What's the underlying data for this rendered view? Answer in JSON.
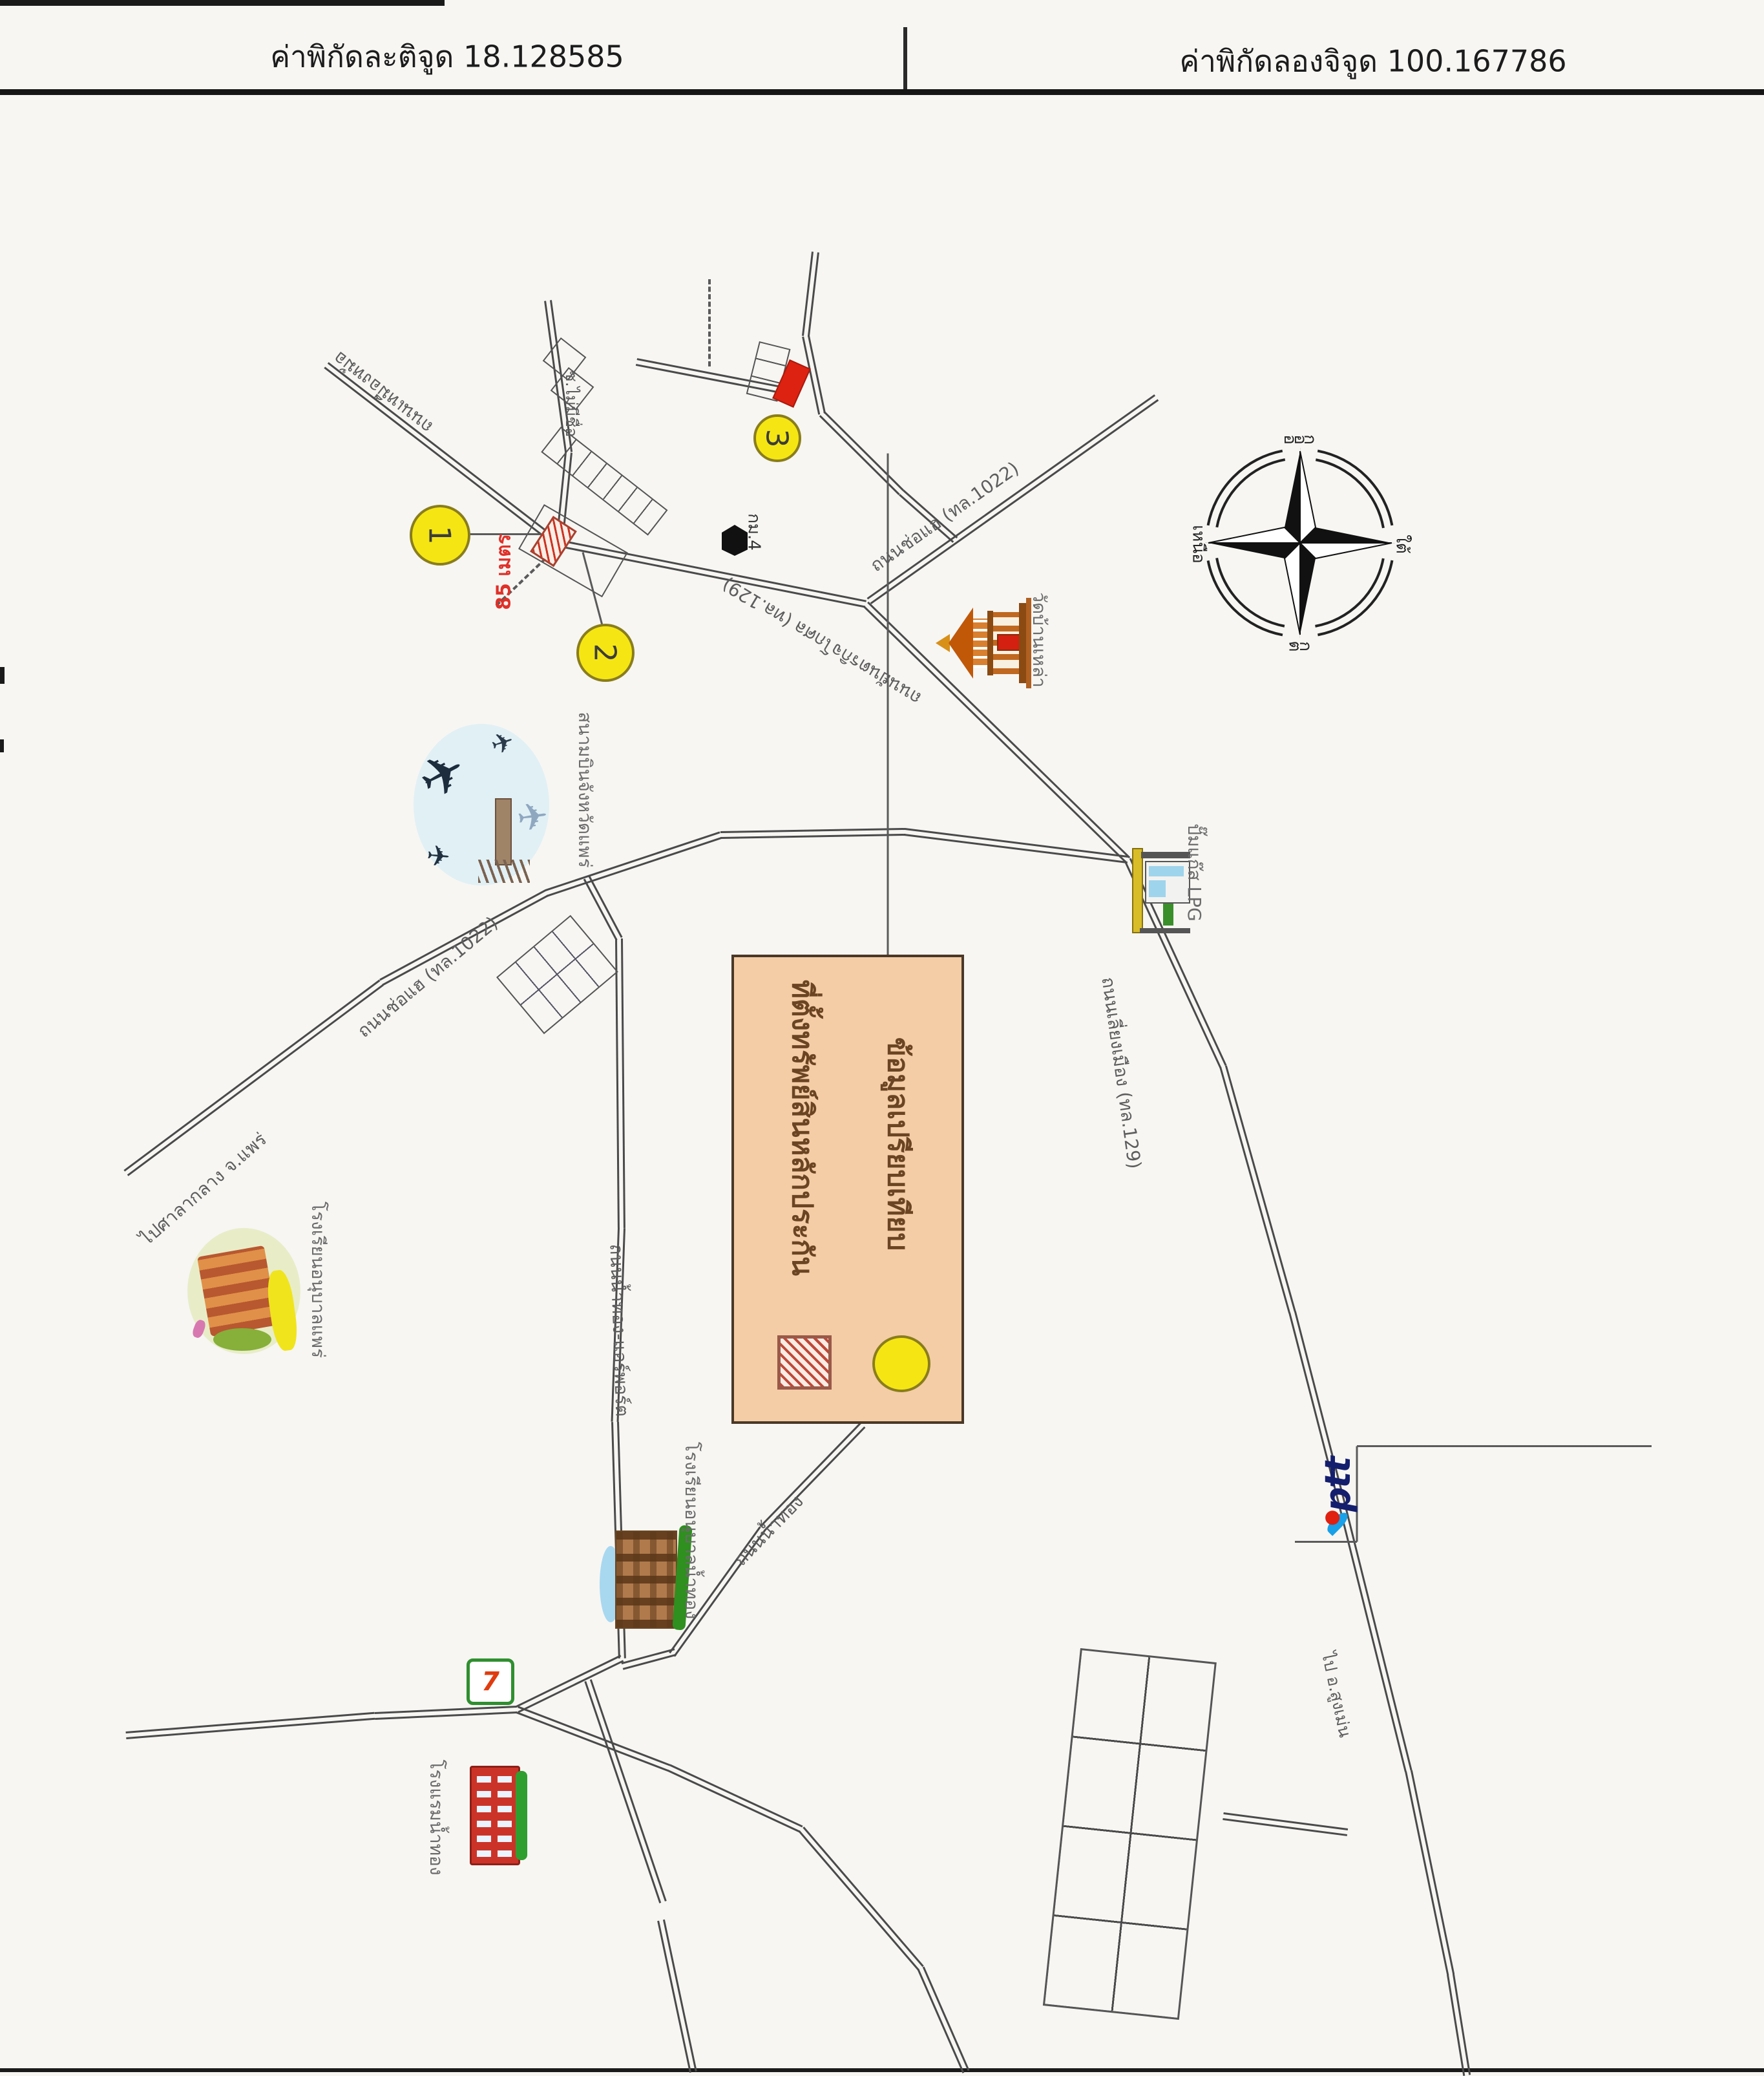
{
  "header": {
    "latitude": "ค่าพิกัดละติจูด 18.128585",
    "longitude": "ค่าพิกัดลองจิจูด 100.167786"
  },
  "compass": {
    "north": "เหนือ",
    "south": "ใต้",
    "east": "ออก",
    "west": "ตก"
  },
  "legend": {
    "property": "ที่ตั้งทรัพย์สินหลักประกัน",
    "comparison": "ข้อมูลเปรียบเทียบ"
  },
  "markers": {
    "one": "1",
    "two": "2",
    "three": "3",
    "distance": "85 เมตร"
  },
  "roads": {
    "yantarakitkosol": "ถนนยันตรกิจโกศล (ทล.129)",
    "chohae": "ถนนช่อแฮ (ทล.1022)",
    "chohae2": "ถนนช่อแฮ (ทล.1022)",
    "liangmueang": "ถนนเลี่ยงเมือง (ทล.129)",
    "namthong_airport": "ถนนน้ำทอง-แอร์พอร์ต",
    "namthong": "ถนนน้ำทอง",
    "mueangmo": "ถนนเหมืองหม้อ",
    "soi_unnamed": "ซ.ไม่มีชื่อ",
    "km_marker": "กม.4",
    "to_city_hall": "ไปศาลากลาง จ.แพร่",
    "to_sungmen": "ไป อ.สูงเม่น"
  },
  "places": {
    "airport": "สนามบินจังหวัดแพร่",
    "temple": "วัดบ้านเหล่า",
    "lpg": "ปั๊มแก๊ส LPG",
    "school_phrae": "โรงเรียนอนุบาลแพร่",
    "school_namthong": "โรงเรียนอนุบาลน้ำทอง",
    "hotel": "โรงแรมน้ำทอง",
    "seven_eleven": "7",
    "ptt": "ptt"
  },
  "colors": {
    "marker_yellow": "#f5e613",
    "legend_bg": "#f4cda6",
    "hatch_red": "#cc3322",
    "solid_red": "#dd2211",
    "road_gray": "#4a4a4a",
    "ptt_navy": "#141e6e",
    "ptt_blue": "#18a0e8",
    "ptt_red": "#e02010"
  }
}
